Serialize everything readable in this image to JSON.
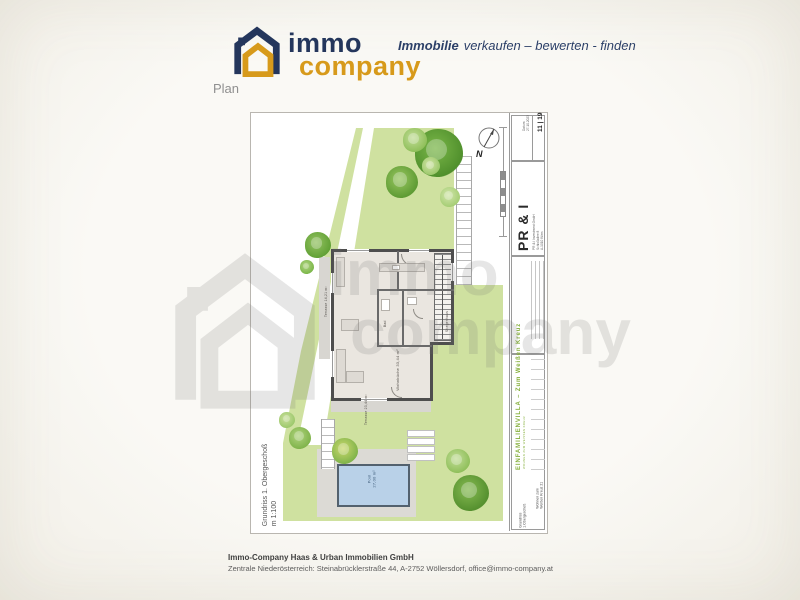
{
  "header": {
    "logo": {
      "word1": "immo",
      "word2": "company"
    },
    "tagline_lead": "Immobilie",
    "tagline_rest": "verkaufen – bewerten - finden",
    "section_label": "Plan"
  },
  "sheet": {
    "side_label": "Grundriss 1. Obergeschoß",
    "side_scale": "m 1:100",
    "compass": "N",
    "titleblock": {
      "date_label": "Datum",
      "date_value": "27.10.2023",
      "sheet_no": "11 | 19",
      "firm_short": "PR & I",
      "firm_lines": [
        "PR & I Investment GmbH",
        "Schloßallee 8",
        "A-1010 Wien"
      ],
      "project_title": "EINFAMILIENVILLA – Zum Weißen Kreuz",
      "project_sub": "WOHNEN ZUM WEISSEN KREUZ",
      "drawing_name_line1": "Grundriss",
      "drawing_name_line2": "1.Obergeschoß",
      "address_line1": "Wohnen zum",
      "address_line2": "Weißen Kreuz 21"
    },
    "labels": {
      "living": "Wohnküche 33,44 m²",
      "stairs": "Stiegenhaus",
      "bath": "Bad",
      "terrace_left": "Terrasse 14,21 m²",
      "terrace_bottom": "Terrasse 23,44 m²",
      "pool_line1": "Pool",
      "pool_line2": "27,00 m²"
    }
  },
  "watermark": {
    "word1": "immo",
    "word2": "company"
  },
  "footer": {
    "company": "Immo-Company Haas & Urban Immobilien GmbH",
    "address": "Zentrale Niederösterreich: Steinabrücklerstraße 44, A-2752 Wöllersdorf, office@immo-company.at"
  },
  "colors": {
    "navy": "#24365c",
    "gold": "#d79a1b",
    "garden": "#cfe1a0",
    "pool": "#b9d1e8"
  }
}
